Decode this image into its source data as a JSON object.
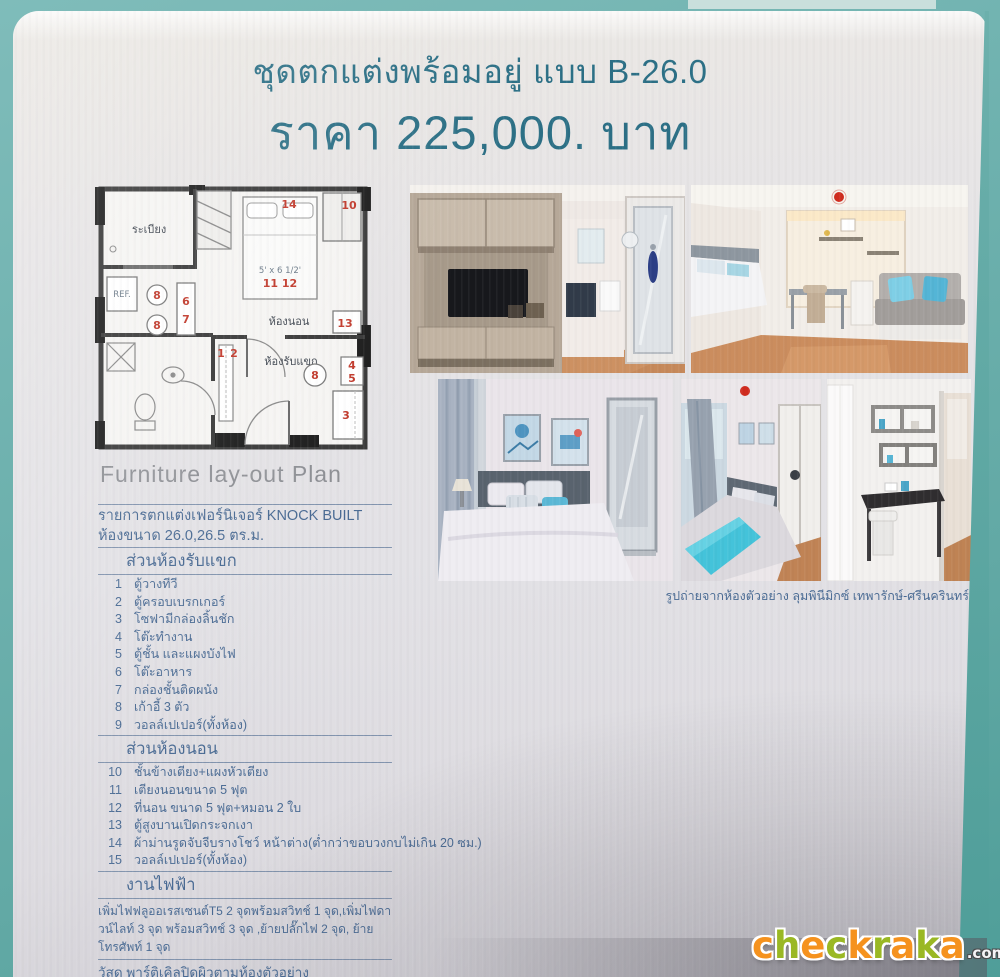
{
  "header": {
    "title": "ชุดตกแต่งพร้อมอยู่ แบบ B-26.0",
    "price": "ราคา 225,000. บาท"
  },
  "floor_plan": {
    "caption": "Furniture lay-out Plan",
    "room_labels": {
      "balcony": "ระเบียง",
      "bedroom": "ห้องนอน",
      "living_room": "ห้องรับแขก"
    },
    "fridge_label": "REF.",
    "bed_size_label": "5' x 6 1/2'",
    "markers": {
      "curtain": "14",
      "blind": "10",
      "bed": "11 12",
      "mirror_cabinet": "13",
      "dining_chair_top": "8",
      "dining_chair_bottom": "8",
      "dining_table_upper": "6",
      "dining_table_lower": "7",
      "tv_cabinet_left": "1",
      "tv_cabinet_right": "2",
      "work_desk": "4",
      "shelf_panel": "5",
      "sofa": "3",
      "living_chair": "8"
    }
  },
  "gallery": {
    "caption": "รูปถ่ายจากห้องตัวอย่าง ลุมพินีมิกซ์ เทพารักษ์-ศรีนครินทร์"
  },
  "details": {
    "header_line1": "รายการตกแต่งเฟอร์นิเจอร์  KNOCK BUILT",
    "header_line2": "ห้องขนาด 26.0,26.5 ตร.ม.",
    "sections": [
      {
        "title": "ส่วนห้องรับแขก",
        "items": [
          {
            "no": "1",
            "label": "ตู้วางทีวี"
          },
          {
            "no": "2",
            "label": "ตู้ครอบเบรกเกอร์"
          },
          {
            "no": "3",
            "label": "โซฟามีกล่องลิ้นชัก"
          },
          {
            "no": "4",
            "label": "โต๊ะทำงาน"
          },
          {
            "no": "5",
            "label": "ตู้ชั้น และแผงบังไฟ"
          },
          {
            "no": "6",
            "label": "โต๊ะอาหาร"
          },
          {
            "no": "7",
            "label": "กล่องชั้นติดผนัง"
          },
          {
            "no": "8",
            "label": "เก้าอี้ 3 ตัว"
          },
          {
            "no": "9",
            "label": "วอลล์เปเปอร์(ทั้งห้อง)"
          }
        ]
      },
      {
        "title": "ส่วนห้องนอน",
        "items": [
          {
            "no": "10",
            "label": "ชั้นข้างเตียง+แผงหัวเตียง"
          },
          {
            "no": "11",
            "label": "เตียงนอนขนาด 5 ฟุต"
          },
          {
            "no": "12",
            "label": "ที่นอน ขนาด 5 ฟุต+หมอน 2 ใบ"
          },
          {
            "no": "13",
            "label": "ตู้สูงบานเปิดกระจกเงา"
          },
          {
            "no": "14",
            "label": "ผ้าม่านรูดจับจีบรางโชว์ หน้าต่าง(ต่ำกว่าขอบวงกบไม่เกิน 20 ซม.)"
          },
          {
            "no": "15",
            "label": "วอลล์เปเปอร์(ทั้งห้อง)"
          }
        ]
      },
      {
        "title": "งานไฟฟ้า",
        "paragraph": "เพิ่มไฟฟลูออเรสเซนต์T5 2 จุดพร้อมสวิทช์ 1 จุด,เพิ่มไฟดาวน์ไลท์ 3 จุด พร้อมสวิทช์ 3 จุด ,ย้ายปลั๊กไฟ 2 จุด, ย้ายโทรศัพท์ 1 จุด"
      }
    ],
    "material_note": "วัสดุ พาร์ติเคิลปิดผิวตามห้องตัวอย่าง"
  },
  "watermark": {
    "letters": [
      "c",
      "h",
      "e",
      "c",
      "k",
      "r",
      "a",
      "k",
      "a"
    ],
    "suffix": ".com"
  },
  "colors": {
    "background_teal": "#6fb0ad",
    "poster": "#e4e2e5",
    "title_text": "#2c7086",
    "list_text": "#4a6b94",
    "plan_marker_red": "#c23a2c",
    "logo_orange": "#f5921e",
    "logo_green": "#9ab824"
  }
}
